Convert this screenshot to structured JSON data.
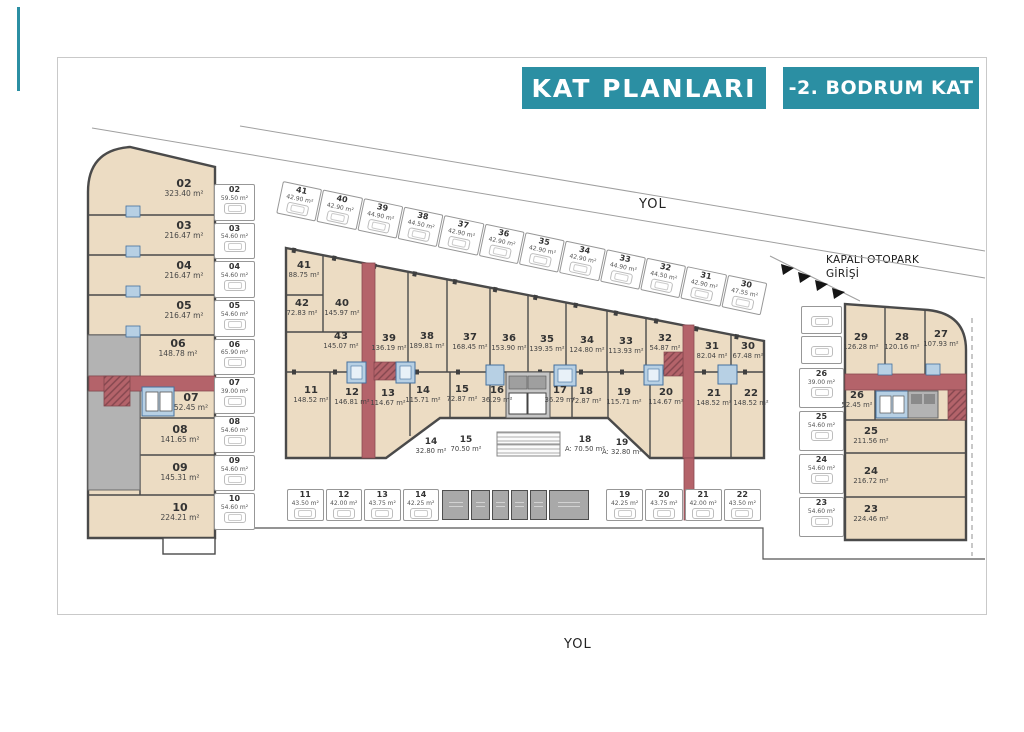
{
  "header": {
    "title": "KAT PLANLARI",
    "floor": "-2. BODRUM KAT"
  },
  "roads": {
    "top": "YOL",
    "bottom": "YOL"
  },
  "entrance": {
    "line1": "KAPALI OTOPARK",
    "line2": "GİRİŞİ"
  },
  "colors": {
    "teal": "#2b8fa3",
    "unit_fill": "#ecdcc3",
    "wall": "#4a4a4a",
    "corridor_red": "#b4636a",
    "core_blue": "#b7d0e4",
    "tech_gray": "#b3b3b3"
  },
  "left_block": {
    "units": [
      {
        "no": "02",
        "area": "323.40 m²"
      },
      {
        "no": "03",
        "area": "216.47 m²"
      },
      {
        "no": "04",
        "area": "216.47 m²"
      },
      {
        "no": "05",
        "area": "216.47 m²"
      },
      {
        "no": "06",
        "area": "148.78 m²"
      },
      {
        "no": "07",
        "area": "52.45 m²"
      },
      {
        "no": "08",
        "area": "141.65 m²"
      },
      {
        "no": "09",
        "area": "145.31 m²"
      },
      {
        "no": "10",
        "area": "224.21 m²"
      }
    ]
  },
  "left_parking": {
    "units": [
      {
        "no": "02",
        "area": "59.50 m²"
      },
      {
        "no": "03",
        "area": "54.60 m²"
      },
      {
        "no": "04",
        "area": "54.60 m²"
      },
      {
        "no": "05",
        "area": "54.60 m²"
      },
      {
        "no": "06",
        "area": "65.90 m²"
      },
      {
        "no": "07",
        "area": "39.00 m²"
      },
      {
        "no": "08",
        "area": "54.60 m²"
      },
      {
        "no": "09",
        "area": "54.60 m²"
      },
      {
        "no": "10",
        "area": "54.60 m²"
      }
    ]
  },
  "street_parking": {
    "units": [
      {
        "no": "41",
        "area": "42.90 m²"
      },
      {
        "no": "40",
        "area": "42.90 m²"
      },
      {
        "no": "39",
        "area": "44.90 m²"
      },
      {
        "no": "38",
        "area": "44.50 m²"
      },
      {
        "no": "37",
        "area": "42.90 m²"
      },
      {
        "no": "36",
        "area": "42.90 m²"
      },
      {
        "no": "35",
        "area": "42.90 m²"
      },
      {
        "no": "34",
        "area": "42.90 m²"
      },
      {
        "no": "33",
        "area": "44.90 m²"
      },
      {
        "no": "32",
        "area": "44.50 m²"
      },
      {
        "no": "31",
        "area": "42.90 m²"
      },
      {
        "no": "30",
        "area": "47.55 m²"
      }
    ]
  },
  "middle_block": {
    "upper_units": [
      {
        "no": "41",
        "area": "88.75 m²"
      },
      {
        "no": "42",
        "area": "72.83 m²"
      },
      {
        "no": "40",
        "area": "145.97 m²"
      },
      {
        "no": "43",
        "area": "145.07 m²"
      },
      {
        "no": "39",
        "area": "136.19 m²"
      },
      {
        "no": "38",
        "area": "189.81 m²"
      },
      {
        "no": "37",
        "area": "168.45 m²"
      },
      {
        "no": "36",
        "area": "153.90 m²"
      },
      {
        "no": "35",
        "area": "139.35 m²"
      },
      {
        "no": "34",
        "area": "124.80 m²"
      },
      {
        "no": "33",
        "area": "113.93 m²"
      },
      {
        "no": "32",
        "area": "54.87 m²"
      },
      {
        "no": "31",
        "area": "82.04 m²"
      },
      {
        "no": "30",
        "area": "67.48 m²"
      }
    ],
    "lower_units": [
      {
        "no": "11",
        "area": "148.52 m²"
      },
      {
        "no": "12",
        "area": "146.81 m²"
      },
      {
        "no": "13",
        "area": "114.67 m²"
      },
      {
        "no": "14",
        "area": "115.71 m²"
      },
      {
        "no": "15",
        "area": "72.87 m²"
      },
      {
        "no": "16",
        "area": "36.29 m²"
      },
      {
        "no": "17",
        "area": "36.29 m²"
      },
      {
        "no": "18",
        "area": "72.87 m²"
      },
      {
        "no": "19",
        "area": "115.71 m²"
      },
      {
        "no": "20",
        "area": "114.67 m²"
      },
      {
        "no": "21",
        "area": "148.52 m²"
      },
      {
        "no": "22",
        "area": "148.52 m²"
      }
    ],
    "outdoor_units": [
      {
        "no": "14",
        "area": "32.80 m²"
      },
      {
        "no": "15",
        "area": "70.50 m²"
      },
      {
        "no": "18",
        "area": "A: 70.50 m²"
      },
      {
        "no": "19",
        "area": "A: 32.80 m²"
      }
    ]
  },
  "bottom_parking": {
    "left_units": [
      {
        "no": "11",
        "area": "43.50 m²"
      },
      {
        "no": "12",
        "area": "42.00 m²"
      },
      {
        "no": "13",
        "area": "43.75 m²"
      },
      {
        "no": "14",
        "area": "42.25 m²"
      }
    ],
    "right_units": [
      {
        "no": "19",
        "area": "42.25 m²"
      },
      {
        "no": "20",
        "area": "43.75 m²"
      },
      {
        "no": "21",
        "area": "42.00 m²"
      },
      {
        "no": "22",
        "area": "43.50 m²"
      }
    ]
  },
  "right_parking": {
    "units": [
      {
        "no": "26",
        "area": "39.00 m²"
      },
      {
        "no": "25",
        "area": "54.60 m²"
      },
      {
        "no": "24",
        "area": "54.60 m²"
      },
      {
        "no": "23",
        "area": "54.60 m²"
      }
    ]
  },
  "right_block": {
    "units": [
      {
        "no": "29",
        "area": "126.28 m²"
      },
      {
        "no": "28",
        "area": "120.16 m²"
      },
      {
        "no": "27",
        "area": "107.93 m²"
      },
      {
        "no": "26",
        "area": "52.45 m²"
      },
      {
        "no": "25",
        "area": "211.56 m²"
      },
      {
        "no": "24",
        "area": "216.72 m²"
      },
      {
        "no": "23",
        "area": "224.46 m²"
      }
    ]
  }
}
